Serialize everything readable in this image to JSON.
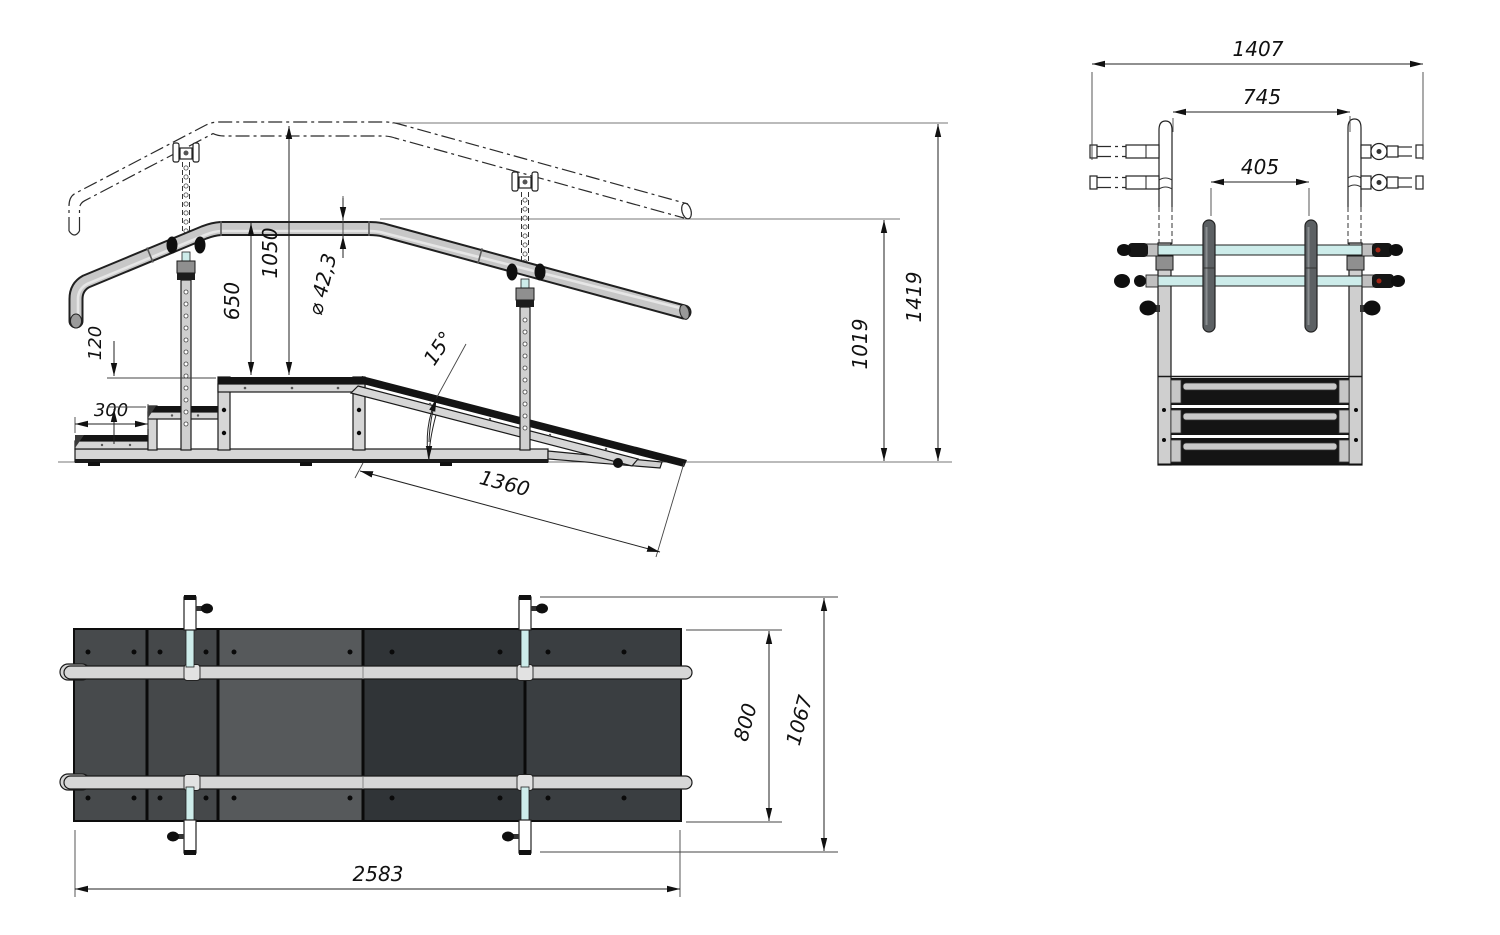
{
  "side_view": {
    "dimensions": {
      "step_depth": "300",
      "step_rise": "120",
      "handrail_low_height": "650",
      "handrail_high_height": "1050",
      "tube_diameter": "⌀ 42,3",
      "ramp_angle": "15°",
      "ramp_length": "1360",
      "handrail_top_height": "1019",
      "overall_height": "1419"
    }
  },
  "front_view": {
    "dimensions": {
      "overall_width": "1407",
      "handrail_clear_spacing": "745",
      "handle_spacing": "405"
    }
  },
  "top_view": {
    "dimensions": {
      "overall_length": "2583",
      "walkway_width": "800",
      "overall_width": "1067"
    }
  },
  "colors": {
    "steel_light": "#d6d6d6",
    "steel_mid": "#c7c7c7",
    "outline": "#1a1a1a",
    "crossbar_cyan": "#cdecea",
    "accent_red": "#a42616",
    "mat_step1": "#474a4c",
    "mat_step2": "#45484a",
    "mat_platform": "#56595b",
    "mat_ramp_dark": "#303437",
    "mat_ramp_mid": "#3a3e41",
    "background": "#ffffff"
  }
}
